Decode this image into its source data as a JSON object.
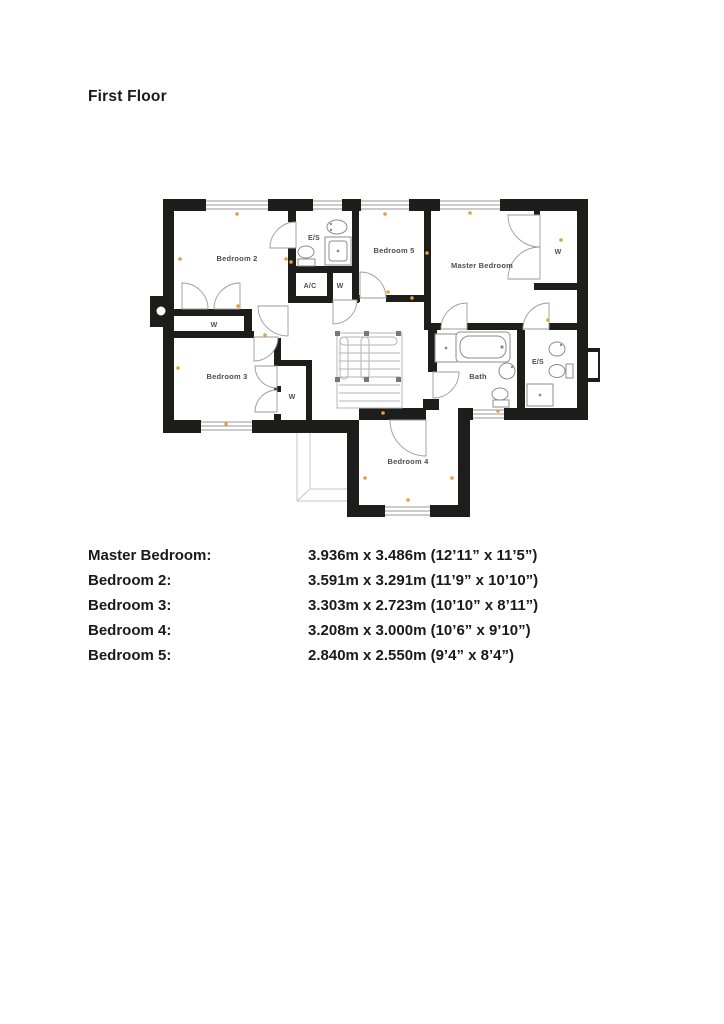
{
  "page": {
    "title": "First Floor"
  },
  "plan": {
    "labels": {
      "bedroom2": "Bedroom 2",
      "es_top": "E/S",
      "ac": "A/C",
      "w_hall": "W",
      "bedroom5": "Bedroom 5",
      "master": "Master Bedroom",
      "w_master": "W",
      "w_bed2": "W",
      "bedroom3": "Bedroom 3",
      "w_bed3": "W",
      "bath": "Bath",
      "es_master": "E/S",
      "bedroom4": "Bedroom 4"
    }
  },
  "dimensions": {
    "rows": [
      {
        "label": "Master Bedroom:",
        "value": "3.936m x 3.486m (12’11” x 11’5”)"
      },
      {
        "label": "Bedroom 2:",
        "value": "3.591m x 3.291m (11’9” x 10’10”)"
      },
      {
        "label": "Bedroom 3:",
        "value": "3.303m x 2.723m (10’10” x 8’11”)"
      },
      {
        "label": "Bedroom 4:",
        "value": "3.208m x 3.000m (10’6” x 9’10”)"
      },
      {
        "label": "Bedroom 5:",
        "value": "2.840m x 2.550m (9’4” x 8’4”)"
      }
    ]
  }
}
